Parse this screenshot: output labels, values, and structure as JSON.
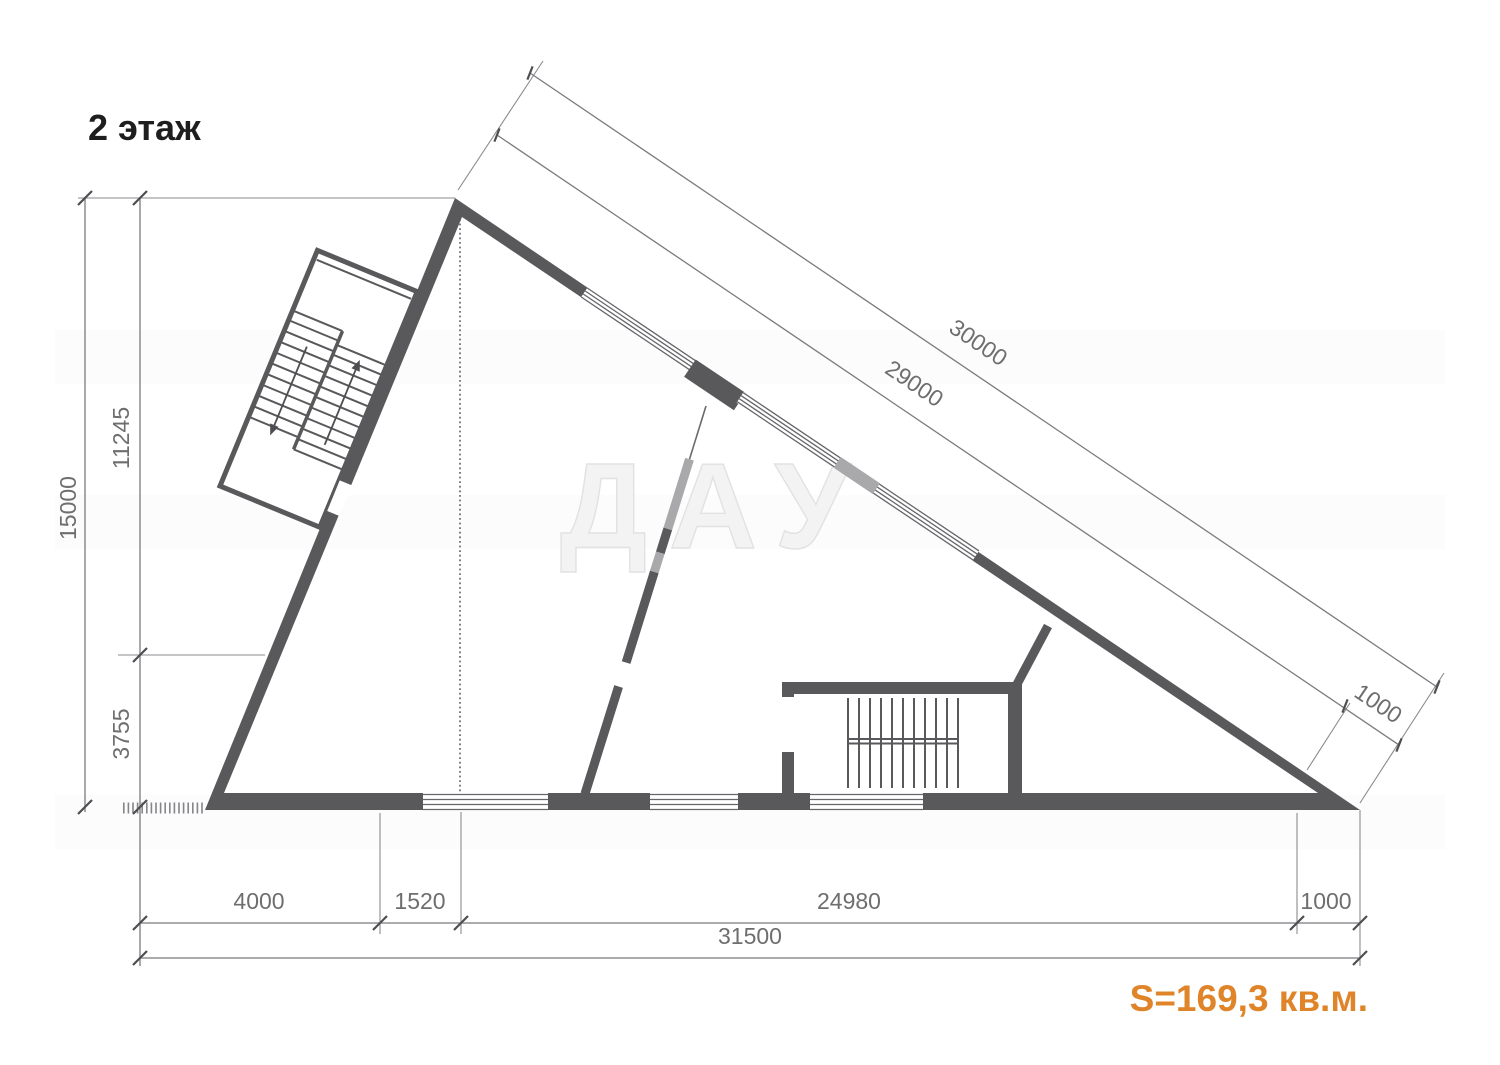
{
  "title": "2 этаж",
  "area": {
    "label": "S=169,3 кв.м.",
    "color": "#e0842a"
  },
  "watermark": {
    "text": "ДАУ"
  },
  "dimensions": {
    "left": {
      "total": "15000",
      "upper": "11245",
      "lower": "3755"
    },
    "hypotenuse": {
      "outer": "30000",
      "inner": "29000",
      "end": "1000"
    },
    "bottom": {
      "d1": "4000",
      "d2": "1520",
      "d3": "24980",
      "d4": "1000",
      "total": "31500"
    }
  },
  "colors": {
    "wall": "#59595c",
    "light_wall": "#a9a9ac",
    "dimension_lines": "#7a7b7d",
    "dimension_text": "#6e6e6e",
    "accent_area": "#e0842a"
  },
  "drawing": {
    "type": "floor-plan",
    "shape": "triangular",
    "features": [
      "upper-stairwell",
      "lower-stairwell",
      "windows",
      "interior-partitions"
    ]
  }
}
